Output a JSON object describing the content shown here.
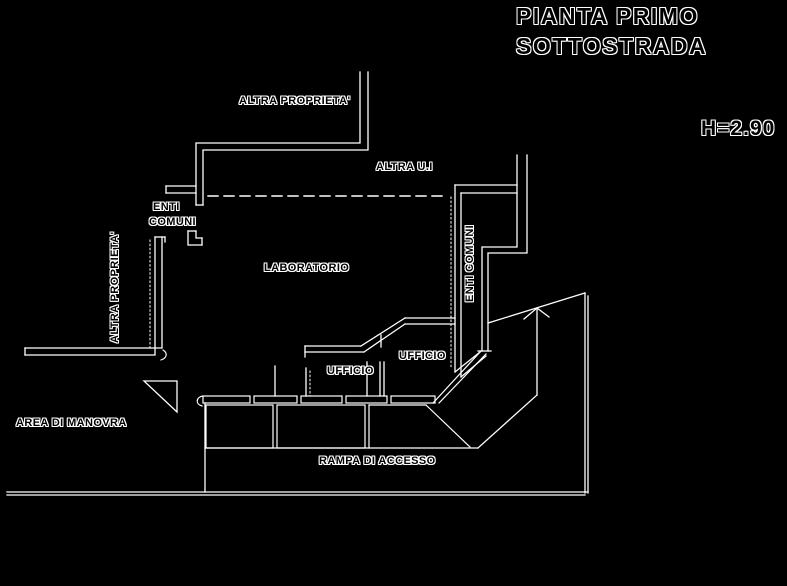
{
  "title": {
    "line1": "PIANTA PRIMO",
    "line2": "SOTTOSTRADA"
  },
  "height_note": "H=2.90",
  "labels": {
    "altra_proprieta_top": "ALTRA PROPRIETA'",
    "altra_ui": "ALTRA U.I",
    "enti_comuni_left_line1": "ENTI",
    "enti_comuni_left_line2": "COMUNI",
    "altra_proprieta_left": "ALTRA PROPRIETA'",
    "laboratorio": "LABORATORIO",
    "enti_comuni_right": "ENTI COMUNI",
    "ufficio_left": "UFFICIO",
    "ufficio_right": "UFFICIO",
    "area_di_manovra": "AREA DI MANOVRA",
    "rampa_di_accesso": "RAMPA DI ACCESSO"
  },
  "colors": {
    "background": "#000000",
    "line": "#ffffff",
    "text_fill": "#000000",
    "text_outline": "#ffffff"
  }
}
